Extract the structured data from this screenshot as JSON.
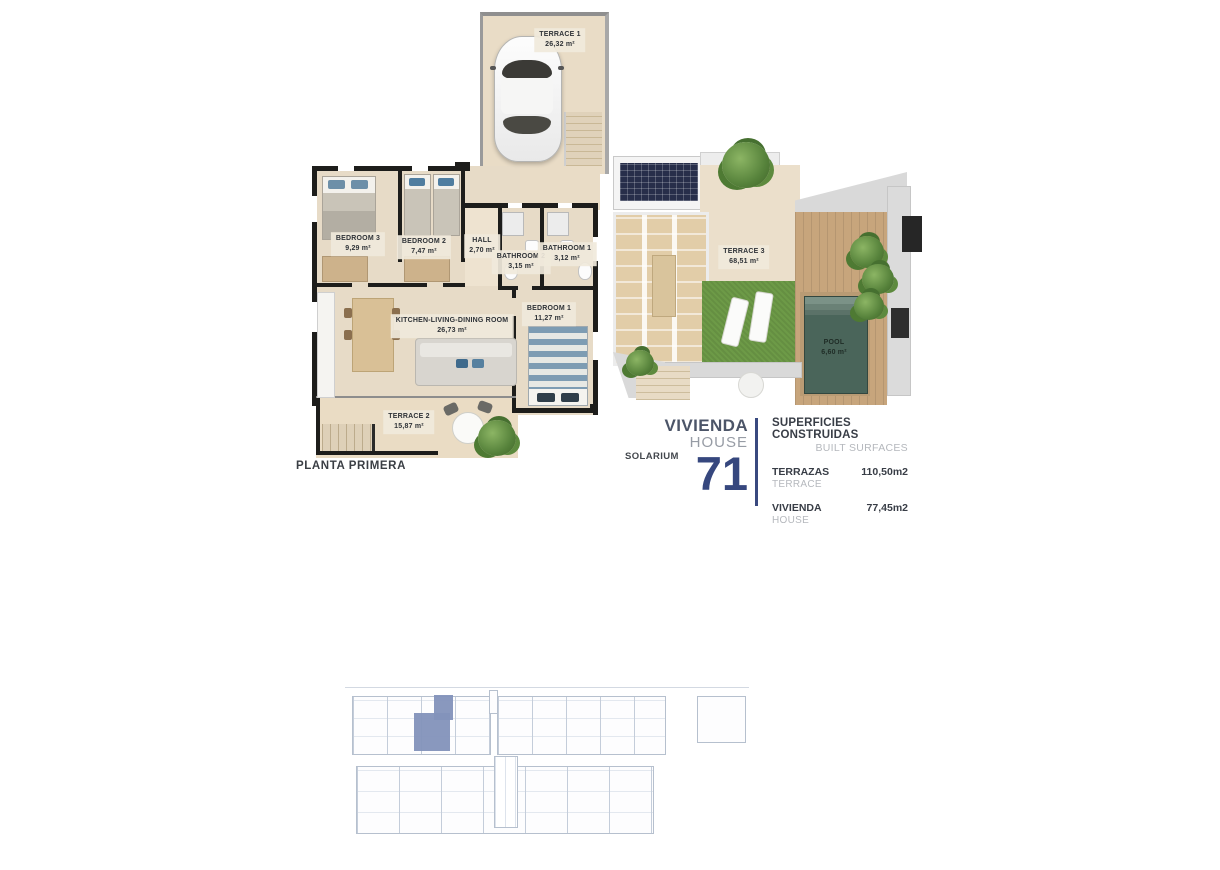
{
  "floor_plan": {
    "label": "PLANTA PRIMERA",
    "rooms": [
      {
        "name": "TERRACE 1",
        "area": "26,32 m²"
      },
      {
        "name": "BEDROOM 3",
        "area": "9,29 m²"
      },
      {
        "name": "BEDROOM 2",
        "area": "7,47 m²"
      },
      {
        "name": "HALL",
        "area": "2,70 m²"
      },
      {
        "name": "BATHROOM 2",
        "area": "3,15 m²"
      },
      {
        "name": "BATHROOM 1",
        "area": "3,12 m²"
      },
      {
        "name": "KITCHEN-LIVING-DINING ROOM",
        "area": "26,73 m²"
      },
      {
        "name": "BEDROOM 1",
        "area": "11,27 m²"
      },
      {
        "name": "TERRACE 2",
        "area": "15,87 m²"
      }
    ]
  },
  "solarium_plan": {
    "label": "SOLARIUM",
    "rooms": [
      {
        "name": "TERRACE 3",
        "area": "68,51 m²"
      },
      {
        "name": "POOL",
        "area": "6,60 m²"
      }
    ]
  },
  "title_block": {
    "name_primary": "VIVIENDA",
    "name_secondary": "HOUSE",
    "number": "71"
  },
  "surfaces": {
    "title": "SUPERFICIES CONSTRUIDAS",
    "subtitle": "BUILT SURFACES",
    "rows": [
      {
        "label": "TERRAZAS",
        "sublabel": "TERRACE",
        "value": "110,50m2"
      },
      {
        "label": "VIVIENDA",
        "sublabel": "HOUSE",
        "value": "77,45m2"
      }
    ]
  },
  "colors": {
    "accent_blue": "#36477e",
    "text_dark": "#383d46",
    "text_gray": "#b5b8bd",
    "wall_black": "#1d1d1b",
    "floor_beige": "#e7dbc7",
    "grass_green": "#6d9a47",
    "pool_water": "#4a655a",
    "deck_wood": "#c7a57c",
    "siteplan_line": "#b6c0ce",
    "siteplan_highlight": "#8392ba"
  }
}
